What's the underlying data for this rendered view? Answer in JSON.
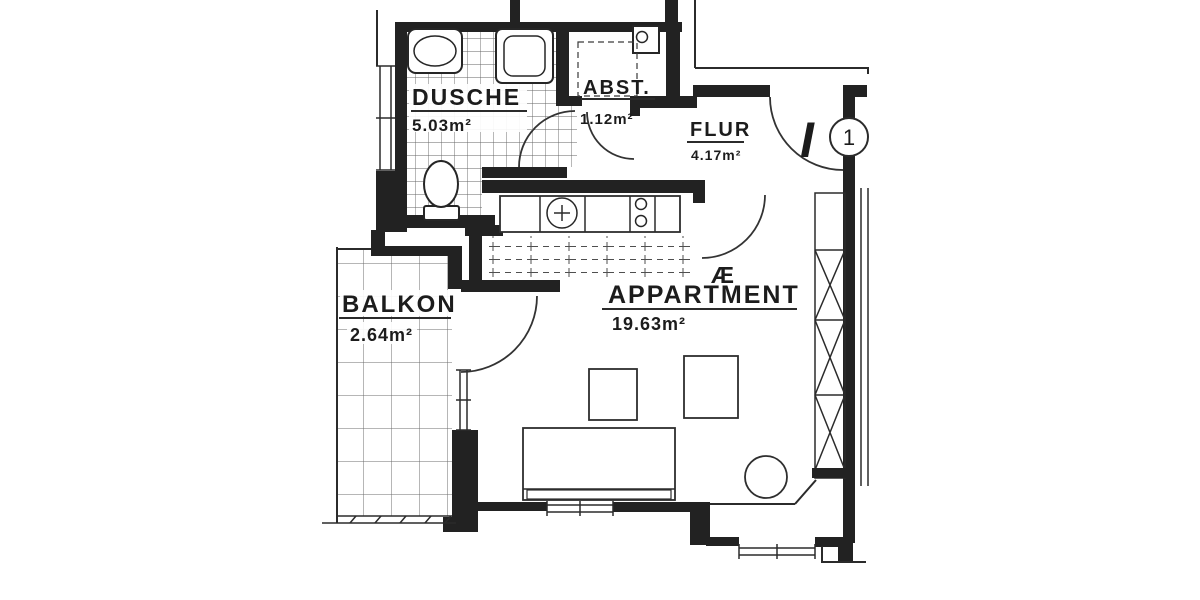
{
  "plan": {
    "title": "apartment-floor-plan-scan",
    "rooms": [
      {
        "id": "dusche",
        "name": "DUSCHE",
        "area": "5.03m²"
      },
      {
        "id": "abst",
        "name": "ABST.",
        "area": "1.12m²"
      },
      {
        "id": "flur",
        "name": "FLUR",
        "area": "4.17m²"
      },
      {
        "id": "appartment",
        "name": "APPARTMENT",
        "area": "19.63m²"
      },
      {
        "id": "balkon",
        "name": "BALKON",
        "area": "2.64m²"
      }
    ],
    "annotations": {
      "entrance_letter": "I",
      "unit_number": "1",
      "overlay_letter": "Æ"
    },
    "ink_color": "#222222",
    "paper_color": "#ffffff"
  }
}
